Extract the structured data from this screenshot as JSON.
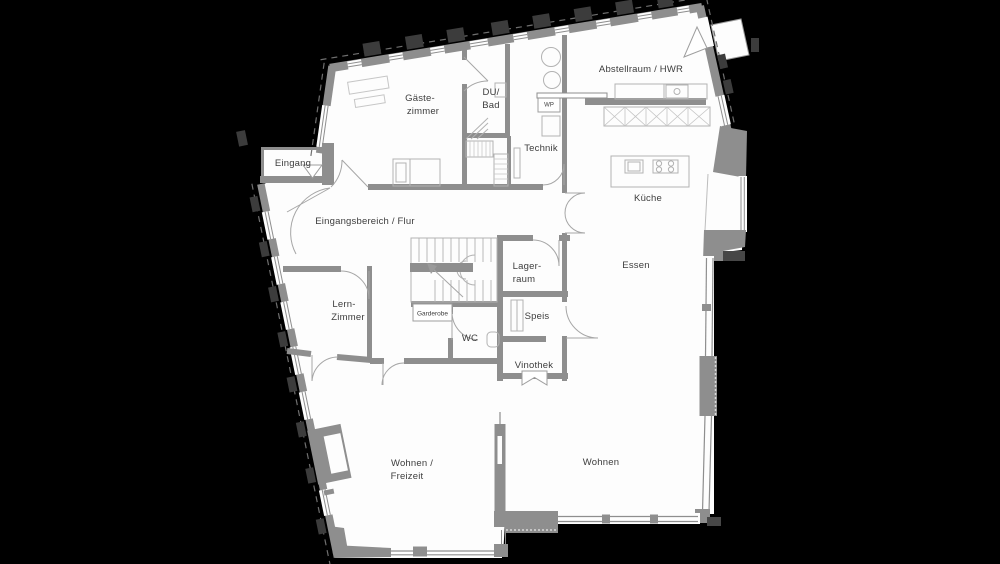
{
  "plan": {
    "rooms": {
      "eingang": {
        "label": "Eingang"
      },
      "gaestezimmer": {
        "line1": "Gäste-",
        "line2": "zimmer"
      },
      "du_bad": {
        "line1": "DU/",
        "line2": "Bad"
      },
      "technik": {
        "label": "Technik"
      },
      "waermepumpe": {
        "label": "WP"
      },
      "abstellraum": {
        "label": "Abstellraum / HWR"
      },
      "kueche": {
        "label": "Küche"
      },
      "eingangsbereich": {
        "label": "Eingangsbereich / Flur"
      },
      "essen": {
        "label": "Essen"
      },
      "lagerraum": {
        "line1": "Lager-",
        "line2": "raum"
      },
      "lernzimmer": {
        "line1": "Lern-",
        "line2": "Zimmer"
      },
      "garderobe": {
        "label": "Garderobe"
      },
      "wc": {
        "label": "WC"
      },
      "speis": {
        "label": "Speis"
      },
      "vinothek": {
        "label": "Vinothek"
      },
      "wohnen_freizeit": {
        "line1": "Wohnen /",
        "line2": "Freizeit"
      },
      "wohnen": {
        "label": "Wohnen"
      }
    },
    "colors": {
      "background": "#000000",
      "floor": "#fdfdfd",
      "wall": "#8e8e8e",
      "text": "#3d3d3d"
    }
  }
}
